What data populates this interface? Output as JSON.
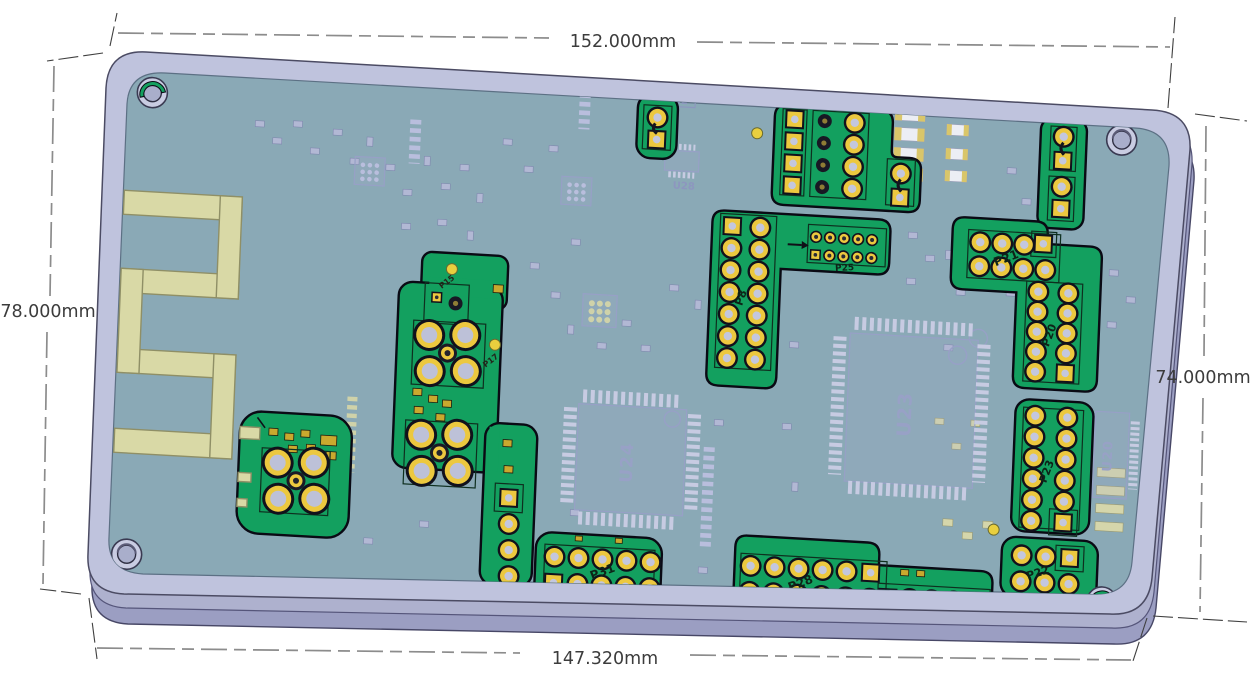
{
  "scene": {
    "background": "#ffffff",
    "description": "3D CAD top view of a rectangular PCB assembly with dimension annotations"
  },
  "dimensions": {
    "top": {
      "label": "152.000mm"
    },
    "bottom": {
      "label": "147.320mm"
    },
    "left": {
      "label": "78.000mm"
    },
    "right": {
      "label": "74.000mm"
    }
  },
  "board": {
    "colors": {
      "carrier_plate": "#bfc3dd",
      "plate_side": "#9b9ec2",
      "pcb_surface": "#8aa9b6",
      "keepout_green": "#13a05f",
      "pad_gold": "#ecc83f",
      "antenna_trace": "#d9d9a6",
      "ghost_silk": "#a0a8cc",
      "hole_ring": "#c9cce2"
    },
    "silkscreen_labels": {
      "u23": "U23",
      "u24": "U24",
      "u20": "U20",
      "u28": "U28",
      "fb2": "FB2",
      "p8": "P8",
      "p15": "P15",
      "p17": "P17",
      "p20": "P20",
      "p21": "P21",
      "p22": "P22",
      "p23": "P23",
      "p25": "P25",
      "p26": "P26",
      "p28": "P28",
      "p31": "P31"
    }
  }
}
